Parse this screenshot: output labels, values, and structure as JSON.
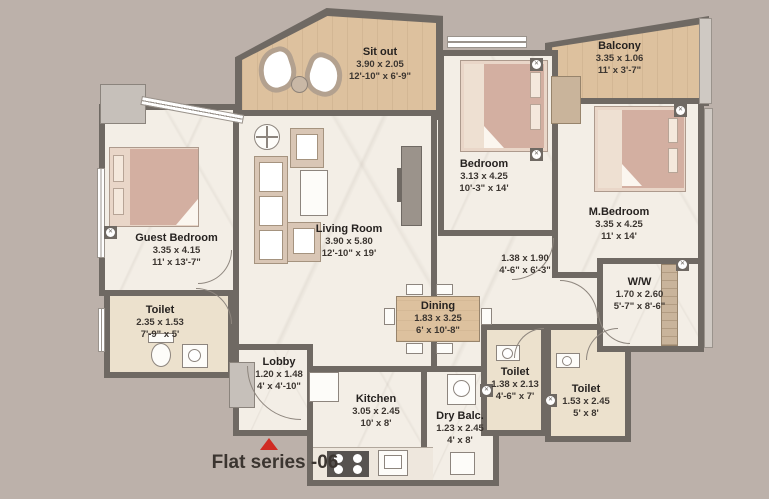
{
  "plan_title": "Flat series -06",
  "rooms": [
    {
      "id": "sitout",
      "name": "Sit out",
      "metric": "3.90 x 2.05",
      "imperial": "12'-10\" x 6'-9\""
    },
    {
      "id": "balcony",
      "name": "Balcony",
      "metric": "3.35 x 1.06",
      "imperial": "11' x 3'-7\""
    },
    {
      "id": "guest_bedroom",
      "name": "Guest Bedroom",
      "metric": "3.35 x 4.15",
      "imperial": "11' x 13'-7\""
    },
    {
      "id": "living_room",
      "name": "Living Room",
      "metric": "3.90 x 5.80",
      "imperial": "12'-10\" x 19'"
    },
    {
      "id": "bedroom",
      "name": "Bedroom",
      "metric": "3.13 x 4.25",
      "imperial": "10'-3\" x 14'"
    },
    {
      "id": "master_bedroom",
      "name": "M.Bedroom",
      "metric": "3.35 x 4.25",
      "imperial": "11' x 14'"
    },
    {
      "id": "toilet_guest",
      "name": "Toilet",
      "metric": "2.35 x 1.53",
      "imperial": "7'-9\" x 5'"
    },
    {
      "id": "lobby",
      "name": "Lobby",
      "metric": "1.20 x 1.48",
      "imperial": "4' x 4'-10\""
    },
    {
      "id": "kitchen",
      "name": "Kitchen",
      "metric": "3.05 x 2.45",
      "imperial": "10' x 8'"
    },
    {
      "id": "dining",
      "name": "Dining",
      "metric": "1.83 x 3.25",
      "imperial": "6' x 10'-8\""
    },
    {
      "id": "passage",
      "name": "",
      "metric": "1.38 x 1.90",
      "imperial": "4'-6\" x 6'-3\""
    },
    {
      "id": "walk_in_wardrobe",
      "name": "W/W",
      "metric": "1.70 x 2.60",
      "imperial": "5'-7\" x 8'-6\""
    },
    {
      "id": "toilet_common",
      "name": "Toilet",
      "metric": "1.38 x 2.13",
      "imperial": "4'-6\" x 7'"
    },
    {
      "id": "toilet_master",
      "name": "Toilet",
      "metric": "1.53 x 2.45",
      "imperial": "5' x 8'"
    },
    {
      "id": "dry_balcony",
      "name": "Dry Balc.",
      "metric": "1.23 x 2.45",
      "imperial": "4' x 8'"
    }
  ],
  "icons": {
    "entrance_marker": "red-triangle-up",
    "column_marker": "circle-cross"
  },
  "colors": {
    "background": "#bcb1aa",
    "wall": "#6f6963",
    "floor_marble": "#f3eee6",
    "floor_wood": "#ddc19e",
    "floor_toilet": "#ece1cd",
    "furniture_rose": "#d3afa1",
    "furniture_cream": "#e9d6c8",
    "entrance_red": "#d02b23",
    "text": "#2e2a26"
  }
}
